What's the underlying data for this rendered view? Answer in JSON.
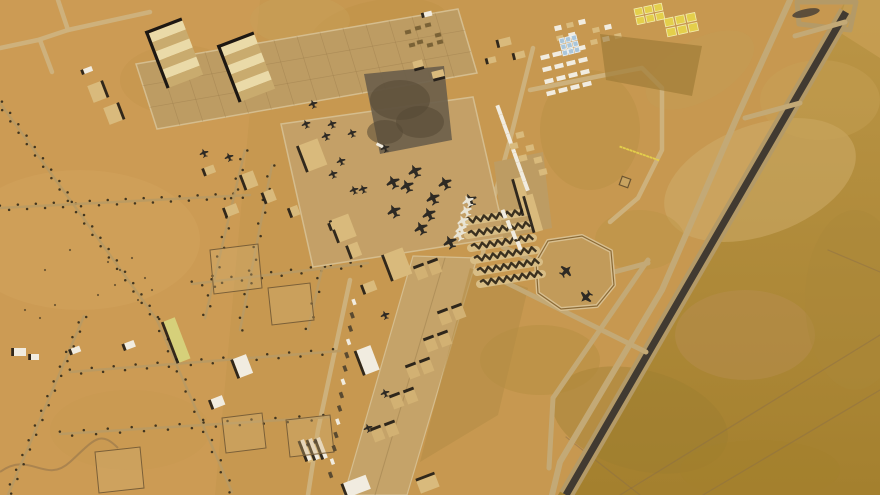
{
  "image": {
    "kind": "satellite-photo",
    "subject": "desert-airbase",
    "width": 880,
    "height": 495
  },
  "palette": {
    "base": "#c79850",
    "left_field": "#cf9e57",
    "paved": "#c4a067",
    "grid_apron": "#bd9c63",
    "strip": "#c5a369",
    "edge": "#d5bd8e",
    "lane": "#9b7d4b",
    "runway": "#413a31",
    "shoulder": "#b49a67",
    "taxiway": "#c3a976",
    "road_light": "#cdb27e",
    "road_bed": "#b99a63",
    "tree": "#322a1a",
    "shadow": "#1d1813",
    "white": "#f1ece0",
    "tan": "#d9ba7c",
    "stripe_a": "#eadaa8",
    "stripe_b": "#c9ab6e",
    "sun_dark": "#3a301f",
    "sun_tan": "#d8bd85",
    "shelter": "#d2b173",
    "yellow": "#e4cf4b",
    "blue": "#aac6da",
    "dark_square": "#6d5f4b",
    "dirt": "#b28c46",
    "olive_top": "#bb9546",
    "olive_bottom": "#a4802e",
    "pocket": "#c79d52",
    "ac_dark": "#2e2a24",
    "ac_light": "#e9e4d4",
    "track": "#8a6d49"
  },
  "terrain": {
    "left_field": {
      "poly": [
        0,
        0,
        260,
        0,
        215,
        495,
        0,
        495
      ],
      "op": 0.55
    },
    "olive_east": {
      "poly": [
        846,
        0,
        880,
        0,
        880,
        495,
        558,
        495
      ]
    },
    "pocket": {
      "poly": [
        846,
        0,
        880,
        0,
        880,
        58,
        836,
        30
      ],
      "op": 0.9
    },
    "patches": [
      [
        760,
        180,
        100,
        55,
        -20,
        "#cfae6c",
        0.5
      ],
      [
        640,
        420,
        90,
        50,
        15,
        "#9c7c30",
        0.4
      ],
      [
        745,
        335,
        70,
        45,
        0,
        "#b78d52",
        0.45
      ],
      [
        820,
        100,
        60,
        40,
        0,
        "#c9a258",
        0.4
      ],
      [
        380,
        30,
        70,
        30,
        -10,
        "#b98f42",
        0.3
      ],
      [
        300,
        20,
        50,
        25,
        0,
        "#c79f58",
        0.5
      ],
      [
        80,
        240,
        120,
        70,
        0,
        "#d4a660",
        0.4
      ],
      [
        180,
        80,
        60,
        35,
        0,
        "#c1934a",
        0.3
      ],
      [
        540,
        360,
        60,
        35,
        0,
        "#b08938",
        0.35
      ],
      [
        640,
        240,
        45,
        30,
        0,
        "#ba9344",
        0.4
      ],
      [
        760,
        470,
        80,
        30,
        0,
        "#a5812c",
        0.45
      ],
      [
        855,
        300,
        50,
        90,
        0,
        "#ab873a",
        0.4
      ],
      [
        130,
        430,
        80,
        40,
        0,
        "#c79950",
        0.35
      ],
      [
        700,
        70,
        60,
        30,
        -30,
        "#c49c54",
        0.5
      ],
      [
        590,
        130,
        50,
        60,
        0,
        "#b68e40",
        0.4
      ]
    ],
    "bush_dots": [
      [
        108,
        262
      ],
      [
        120,
        270
      ],
      [
        132,
        258
      ],
      [
        145,
        278
      ],
      [
        152,
        290
      ],
      [
        115,
        285
      ],
      [
        98,
        295
      ],
      [
        138,
        300
      ],
      [
        25,
        310
      ],
      [
        40,
        318
      ],
      [
        55,
        305
      ],
      [
        70,
        250
      ],
      [
        45,
        270
      ]
    ]
  },
  "tracks": [
    [
      620,
      495,
      880,
      335
    ],
    [
      703,
      495,
      880,
      390
    ],
    [
      566,
      437,
      640,
      495
    ],
    [
      828,
      250,
      880,
      272
    ]
  ],
  "curve_track": "M0,472 C30,450 45,485 70,462 S100,430 118,448",
  "runway": {
    "x1": 846,
    "y1": 12,
    "x2": 566,
    "y2": 495,
    "width": 7,
    "shoulder_width": 15,
    "threshold_poly": [
      797,
      2,
      856,
      2,
      850,
      30,
      799,
      24
    ],
    "skid": [
      806,
      13,
      14,
      4,
      -12
    ]
  },
  "taxiways": {
    "parallel": [
      790,
      0,
      738,
      115,
      662,
      290,
      560,
      462,
      552,
      495
    ],
    "width": 6,
    "connectors": [
      [
        845,
        22,
        795,
        36
      ],
      [
        800,
        103,
        745,
        118
      ],
      [
        505,
        282,
        646,
        352
      ],
      [
        648,
        260,
        553,
        398
      ],
      [
        553,
        398,
        549,
        468
      ],
      [
        503,
        247,
        536,
        262
      ],
      [
        614,
        272,
        648,
        263
      ]
    ]
  },
  "roads": {
    "light": [
      [
        58,
        0,
        68,
        30,
        150,
        12
      ],
      [
        68,
        30,
        38,
        40,
        0,
        48
      ],
      [
        40,
        40,
        52,
        72
      ],
      [
        350,
        116,
        452,
        168
      ],
      [
        350,
        280,
        318,
        430,
        308,
        495
      ],
      [
        533,
        48,
        510,
        140,
        492,
        205,
        482,
        258
      ],
      [
        530,
        90,
        600,
        76,
        642,
        68,
        662,
        88,
        662,
        150,
        638,
        198,
        610,
        222
      ],
      [
        495,
        205,
        512,
        240
      ]
    ],
    "tree_lined": [
      {
        "pts": [
          0,
          103,
          157,
          320
        ],
        "spacing": 7
      },
      {
        "pts": [
          157,
          320,
          232,
          492
        ],
        "spacing": 11
      },
      {
        "pts": [
          84,
          316,
          8,
          495
        ],
        "spacing": 8
      },
      {
        "pts": [
          0,
          208,
          250,
          195
        ],
        "spacing": 9
      },
      {
        "pts": [
          245,
          150,
          205,
          318
        ],
        "spacing": 10
      },
      {
        "pts": [
          272,
          165,
          240,
          330
        ],
        "spacing": 12
      },
      {
        "pts": [
          192,
          284,
          368,
          263
        ],
        "spacing": 10
      },
      {
        "pts": [
          70,
          372,
          340,
          351
        ],
        "spacing": 11
      },
      {
        "pts": [
          60,
          434,
          330,
          417
        ],
        "spacing": 12
      },
      {
        "pts": [
          340,
          190,
          308,
          330
        ],
        "spacing": 13
      }
    ]
  },
  "aprons": {
    "grid": {
      "poly": [
        136,
        64,
        458,
        9,
        477,
        73,
        157,
        129
      ],
      "cross_lines": 14,
      "long_lines": 2
    },
    "central": {
      "poly": [
        281,
        124,
        473,
        97,
        505,
        237,
        313,
        267
      ]
    },
    "strip": {
      "poly": [
        413,
        256,
        477,
        258,
        407,
        495,
        344,
        495
      ]
    },
    "east_pad": {
      "poly": [
        494,
        162,
        543,
        152,
        552,
        228,
        503,
        238
      ]
    },
    "dirt_east": {
      "poly": [
        470,
        268,
        528,
        288,
        498,
        415,
        420,
        462
      ],
      "op": 0.55
    }
  },
  "dark_square": {
    "poly": [
      364,
      74,
      444,
      66,
      452,
      140,
      380,
      154
    ],
    "spots": [
      [
        400,
        100,
        30,
        20
      ],
      [
        420,
        122,
        24,
        16
      ],
      [
        385,
        132,
        18,
        12
      ]
    ],
    "white_dash": [
      381,
      146,
      10,
      3,
      28
    ]
  },
  "octagon": {
    "pts": [
      536,
      262,
      548,
      241,
      582,
      236,
      611,
      251,
      614,
      285,
      597,
      306,
      561,
      309,
      538,
      293
    ]
  },
  "sunshades": {
    "rows": [
      [
        465,
        222
      ],
      [
        468,
        235
      ],
      [
        471,
        248
      ],
      [
        474,
        260
      ],
      [
        477,
        272
      ],
      [
        480,
        284
      ]
    ],
    "length": 62,
    "drop": -10,
    "teeth": 8
  },
  "shelter_pairs": [
    [
      428,
      270
    ],
    [
      452,
      315
    ],
    [
      438,
      342
    ],
    [
      420,
      369
    ],
    [
      404,
      399
    ],
    [
      385,
      432
    ]
  ],
  "hangars_striped": [
    [
      176,
      54,
      36,
      58,
      -21
    ],
    [
      248,
      68,
      36,
      58,
      -21
    ]
  ],
  "buildings": {
    "tan": [
      [
        313,
        155,
        20,
        28,
        -21,
        "l"
      ],
      [
        344,
        228,
        18,
        24,
        -21,
        "l"
      ],
      [
        398,
        264,
        20,
        28,
        -21,
        "l"
      ],
      [
        97,
        92,
        14,
        18,
        -21,
        "r"
      ],
      [
        113,
        114,
        14,
        18,
        -21,
        "r"
      ],
      [
        523,
        196,
        8,
        38,
        -16,
        "l"
      ],
      [
        534,
        213,
        8,
        38,
        -16,
        "l"
      ],
      [
        250,
        180,
        12,
        16,
        -21,
        "l"
      ],
      [
        270,
        196,
        10,
        12,
        -21,
        "l"
      ],
      [
        232,
        210,
        12,
        10,
        -21,
        "l"
      ],
      [
        295,
        211,
        8,
        10,
        -21,
        "l"
      ],
      [
        210,
        170,
        10,
        8,
        -21,
        "l"
      ],
      [
        355,
        250,
        10,
        14,
        -21,
        "l"
      ],
      [
        370,
        287,
        12,
        10,
        -21,
        "l"
      ],
      [
        418,
        64,
        10,
        7,
        -14,
        "b"
      ],
      [
        438,
        74,
        12,
        7,
        -14,
        "b"
      ],
      [
        428,
        484,
        20,
        13,
        -21,
        "t"
      ],
      [
        315,
        452,
        20,
        16,
        -21,
        "t"
      ],
      [
        335,
        225,
        8,
        8,
        -21,
        "l"
      ],
      [
        505,
        42,
        12,
        8,
        -14,
        "l"
      ],
      [
        520,
        55,
        10,
        7,
        -14,
        "l"
      ],
      [
        492,
        60,
        8,
        6,
        -14,
        "l"
      ]
    ],
    "white": [
      [
        368,
        360,
        15,
        26,
        -21
      ],
      [
        357,
        486,
        24,
        15,
        -21
      ],
      [
        88,
        70,
        9,
        5,
        -21
      ],
      [
        130,
        345,
        10,
        7,
        -21
      ],
      [
        76,
        350,
        9,
        6,
        -21
      ],
      [
        20,
        352,
        12,
        8,
        0
      ],
      [
        35,
        357,
        8,
        6,
        0
      ],
      [
        243,
        366,
        14,
        20,
        -21
      ],
      [
        218,
        402,
        12,
        10,
        -21
      ],
      [
        306,
        450,
        4,
        22,
        -21
      ],
      [
        314,
        449,
        4,
        22,
        -21
      ],
      [
        322,
        448,
        4,
        22,
        -21
      ],
      [
        428,
        14,
        8,
        5,
        -14
      ]
    ],
    "yellow_long": [
      177,
      340,
      12,
      44,
      -21
    ],
    "dark_tents": [
      [
        408,
        32
      ],
      [
        418,
        28
      ],
      [
        428,
        25
      ],
      [
        438,
        35
      ],
      [
        420,
        42
      ],
      [
        430,
        45
      ],
      [
        440,
        42
      ],
      [
        412,
        45
      ]
    ],
    "compounds": [
      [
        210,
        250,
        258,
        244,
        262,
        288,
        214,
        294
      ],
      [
        268,
        288,
        310,
        283,
        314,
        320,
        272,
        325
      ],
      [
        222,
        418,
        262,
        413,
        266,
        448,
        226,
        453
      ],
      [
        286,
        420,
        330,
        415,
        334,
        452,
        290,
        457
      ],
      [
        95,
        452,
        140,
        447,
        144,
        488,
        99,
        493
      ]
    ]
  },
  "strip_column": {
    "start": [
      354,
      302
    ],
    "step": [
      -1.8,
      13.3
    ],
    "count": 14,
    "w": 6,
    "h": 3.5,
    "rot": 70
  },
  "cantonment": {
    "east_grid": {
      "origin": [
        545,
        57
      ],
      "cols": 4,
      "rows": 4,
      "dx": [
        12,
        -3
      ],
      "dy": [
        2,
        12
      ],
      "w": 9,
      "h": 4.5,
      "rot": -14
    },
    "west_column": {
      "origin": [
        499,
        110
      ],
      "rows": 9,
      "dy": [
        3.4,
        9.5
      ],
      "w": 10,
      "h": 4,
      "rot": 70
    },
    "south_column": {
      "origin": [
        504,
        214
      ],
      "rows": 4,
      "dy": [
        5,
        10.5
      ],
      "w": 9,
      "h": 4,
      "rot": 70
    },
    "tan_tents": [
      [
        520,
        135
      ],
      [
        530,
        148
      ],
      [
        538,
        160
      ],
      [
        523,
        158
      ],
      [
        514,
        146
      ],
      [
        543,
        172
      ]
    ],
    "north_cluster": [
      [
        558,
        28
      ],
      [
        570,
        25
      ],
      [
        582,
        22
      ],
      [
        560,
        38
      ],
      [
        572,
        35
      ],
      [
        596,
        30
      ],
      [
        608,
        27
      ],
      [
        594,
        42
      ],
      [
        606,
        39
      ],
      [
        618,
        36
      ]
    ],
    "blue_grid": {
      "origin": [
        559,
        39
      ],
      "cols": 3,
      "rows": 3,
      "cell": [
        5,
        5
      ],
      "gap": 1.2,
      "rot": -14
    },
    "yellow_grids": [
      {
        "origin": [
          634,
          9
        ],
        "cols": 3,
        "rows": 2,
        "cell": [
          8,
          7
        ],
        "gap": 2,
        "rot": -12
      },
      {
        "origin": [
          664,
          19
        ],
        "cols": 3,
        "rows": 2,
        "cell": [
          9,
          8
        ],
        "gap": 2.2,
        "rot": -12
      }
    ],
    "dark_patch": [
      600,
      34,
      702,
      46,
      692,
      96,
      606,
      80
    ],
    "yellow_dashes": {
      "from": [
        621,
        147
      ],
      "to": [
        661,
        161
      ],
      "count": 12
    },
    "square_structure": [
      625,
      182,
      9,
      9,
      20
    ]
  },
  "aircraft": {
    "small": [
      [
        306,
        124
      ],
      [
        332,
        124
      ],
      [
        326,
        136
      ],
      [
        352,
        133
      ],
      [
        341,
        161
      ],
      [
        333,
        174
      ],
      [
        354,
        190
      ],
      [
        363,
        189
      ],
      [
        385,
        148
      ],
      [
        313,
        104
      ],
      [
        204,
        153
      ],
      [
        229,
        157
      ],
      [
        385,
        315
      ],
      [
        385,
        393
      ],
      [
        368,
        428
      ]
    ],
    "medium": [
      [
        415,
        171
      ],
      [
        407,
        186
      ],
      [
        445,
        183
      ],
      [
        393,
        182
      ],
      [
        429,
        214
      ],
      [
        421,
        228
      ],
      [
        394,
        211
      ],
      [
        450,
        242
      ],
      [
        433,
        198
      ],
      [
        470,
        200
      ]
    ],
    "white": [
      [
        468,
        201
      ],
      [
        466,
        211
      ],
      [
        463,
        221
      ],
      [
        461,
        229
      ],
      [
        459,
        235
      ]
    ],
    "octagon": [
      [
        566,
        271,
        45
      ],
      [
        586,
        297,
        225
      ]
    ],
    "rot_small": -20,
    "rot_medium": -25
  }
}
